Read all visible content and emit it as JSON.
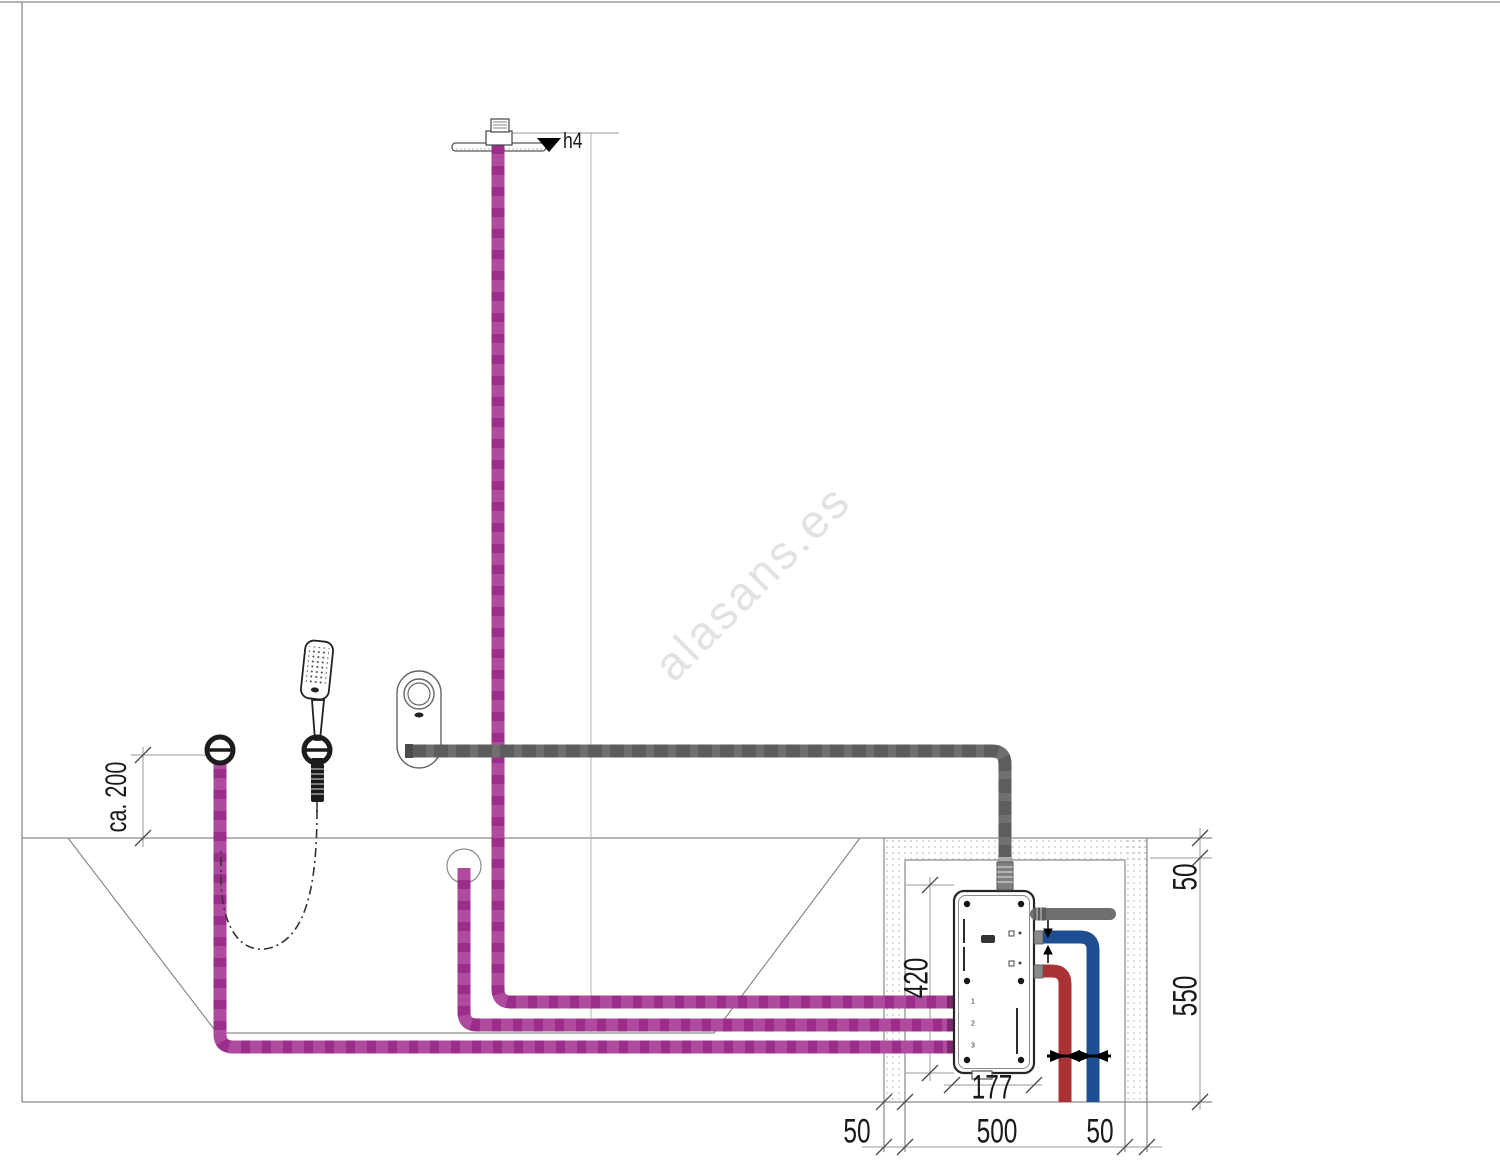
{
  "watermark": {
    "text": "alasans.es",
    "color": "#e2e2e2"
  },
  "dimensions": {
    "height_ref": "h4",
    "outlet_height": "ca. 200",
    "box_height": "420",
    "box_width": "177",
    "bottom_left": "50",
    "bottom_center": "500",
    "bottom_right": "50",
    "right_top": "50",
    "right_bottom": "550"
  },
  "smartbox": {
    "ports": [
      "1",
      "2",
      "3"
    ]
  },
  "colors": {
    "supply_pipe": "#9b2e8a",
    "supply_pipe_dash": "#c468b1",
    "control_pipe": "#6f6f6f",
    "control_pipe_dash": "#535353",
    "hot_pipe": "#a83236",
    "cold_pipe": "#1d4e91",
    "thin_line": "#8a8a8a",
    "dim_line": "#9a9a9a",
    "text": "#1a1a1a"
  }
}
